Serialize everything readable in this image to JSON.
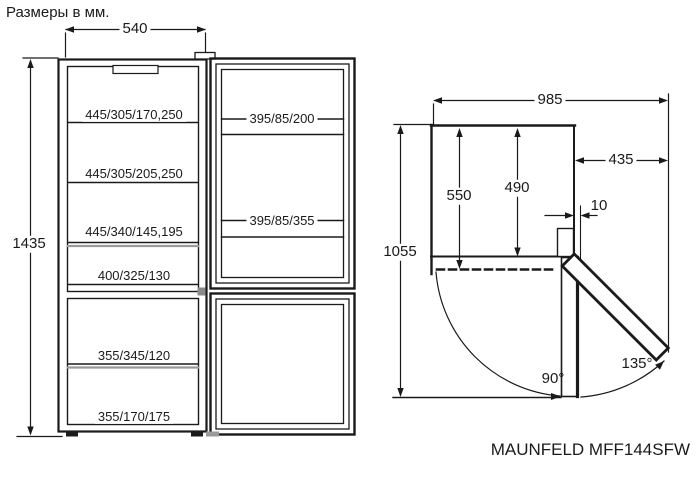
{
  "title": "Размеры в мм.",
  "model": "MAUNFELD MFF144SFW",
  "front_view": {
    "width": "540",
    "height": "1435",
    "cabinet_shelves": [
      "445/305/170,250",
      "445/305/205,250",
      "445/340/145,195",
      "400/325/130"
    ],
    "freezer_shelves": [
      "355/345/120",
      "355/170/175"
    ],
    "door_bins": [
      "395/85/200",
      "395/85/355"
    ]
  },
  "top_view": {
    "total_width": "985",
    "side_clearance": "435",
    "depth_with_door": "550",
    "depth_body": "490",
    "depth_door_open": "1055",
    "door_protrusion": "10",
    "open_angle": "90°",
    "max_open_angle": "135°"
  }
}
